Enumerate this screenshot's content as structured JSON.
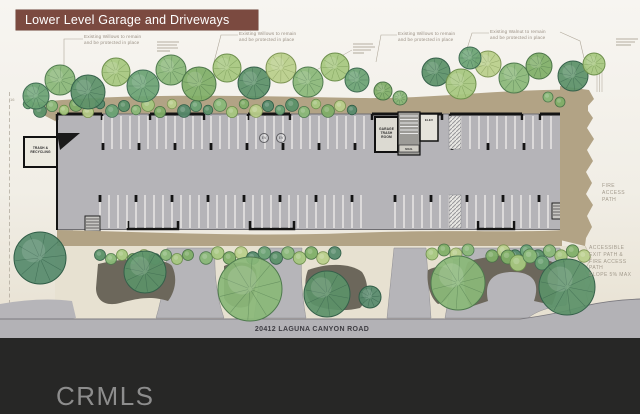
{
  "header": {
    "title": "Lower Level Garage and Driveways"
  },
  "plan": {
    "tree_notes": [
      {
        "text": "Existing Willows to remain\nand be protected in place"
      },
      {
        "text": "Existing Willows to remain\nand be protected in place"
      },
      {
        "text": "Existing Willows to remain\nand be protected in place"
      },
      {
        "text": "Existing Walnut to remain\nand be protected in place"
      }
    ],
    "rooms": {
      "trash_recycling": "TRASH &\nRECYCLING",
      "garage_trash": "GARAGE\nTRASH\nROOM",
      "elevator": "ELEV",
      "mail": "MAIL"
    },
    "ev_label": "EV",
    "notes": {
      "fire_access": "FIRE\nACCESS\nPATH",
      "accessible_exit": "ACCESSIBLE\nEXIT PATH &\nFIRE ACCESS\nPATH\nSLOPE 5% MAX"
    },
    "scale_mark": "16"
  },
  "road": {
    "label": "20412 LAGUNA CANYON ROAD"
  },
  "footer": {
    "watermark": "CRMLS"
  },
  "colors": {
    "title_bar": "#7b4a40",
    "paper": "#f1eee6",
    "garage_floor": "#b5b4b8",
    "building_band": "#b2a385",
    "planting_bed": "#6c675b",
    "road": "#b3b2b6",
    "footer": "#272726",
    "tree_green": "#6aa273"
  }
}
